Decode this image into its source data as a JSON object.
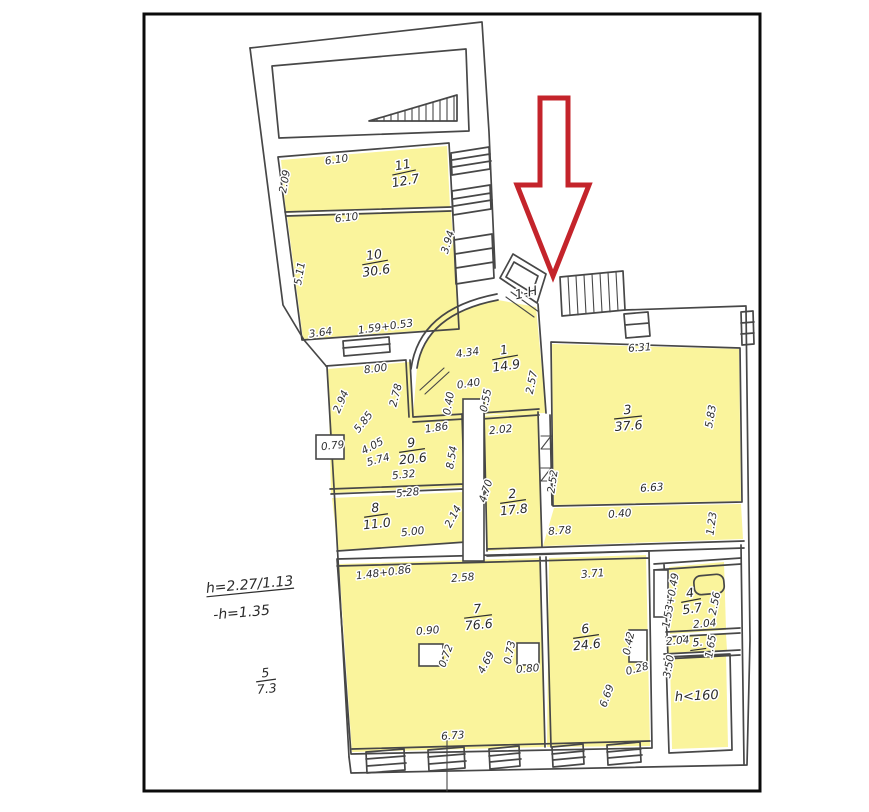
{
  "plan": {
    "type": "apartment-floor-plan-scan",
    "entrance_label": "1-Н",
    "colors": {
      "highlight_fill": "#FAF49C",
      "wall_ink": "#474747",
      "arrow_red": "#C4242B",
      "frame_black": "#0b0b0b",
      "paper": "#ffffff"
    }
  },
  "rooms": [
    {
      "name": "room-11-label",
      "num": "11",
      "area": "12.7",
      "x": 404,
      "y": 172,
      "r": -10,
      "w": 24
    },
    {
      "name": "room-10-label",
      "num": "10",
      "area": "30.6",
      "x": 375,
      "y": 262,
      "r": -8,
      "w": 26
    },
    {
      "name": "room-1-label",
      "num": "1",
      "area": "14.9",
      "x": 505,
      "y": 357,
      "r": -8,
      "w": 26
    },
    {
      "name": "room-3-label",
      "num": "3",
      "area": "37.6",
      "x": 628,
      "y": 417,
      "r": -4,
      "w": 28
    },
    {
      "name": "room-9-label",
      "num": "9",
      "area": "20.6",
      "x": 412,
      "y": 450,
      "r": -6,
      "w": 26
    },
    {
      "name": "room-8-label",
      "num": "8",
      "area": "11.0",
      "x": 376,
      "y": 515,
      "r": -6,
      "w": 24
    },
    {
      "name": "room-2-label",
      "num": "2",
      "area": "17.8",
      "x": 513,
      "y": 501,
      "r": -6,
      "w": 26
    },
    {
      "name": "room-7-label",
      "num": "7",
      "area": "76.6",
      "x": 478,
      "y": 616,
      "r": -5,
      "w": 28
    },
    {
      "name": "room-6-label",
      "num": "6",
      "area": "24.6",
      "x": 586,
      "y": 636,
      "r": -6,
      "w": 26
    },
    {
      "name": "room-4-label",
      "num": "4",
      "area": "5.7",
      "x": 691,
      "y": 600,
      "r": -8,
      "w": 20
    },
    {
      "name": "room-5-area-note",
      "num": "5",
      "area": "7.3",
      "x": 266,
      "y": 680,
      "r": -5,
      "w": 20
    }
  ],
  "labels": [
    {
      "name": "entrance-label",
      "t": "1-Н",
      "x": 527,
      "y": 297,
      "r": -12,
      "s": 13
    },
    {
      "name": "height-note-1",
      "t": "h=2.27/1.13",
      "x": 250,
      "y": 589,
      "r": -5,
      "s": 14,
      "ul": 88
    },
    {
      "name": "height-note-2",
      "t": "-h=1.35",
      "x": 242,
      "y": 617,
      "r": -5,
      "s": 14
    },
    {
      "name": "low-height-label",
      "t": "h<160",
      "x": 697,
      "y": 700,
      "r": -3,
      "s": 13
    },
    {
      "name": "room-5-number",
      "t": "5.",
      "x": 698,
      "y": 646,
      "r": -4,
      "s": 11,
      "ul": 16
    }
  ],
  "dimensions": [
    {
      "t": "6.10",
      "x": 337,
      "y": 163,
      "r": -8
    },
    {
      "t": "2.09",
      "x": 288,
      "y": 182,
      "r": -80
    },
    {
      "t": "6.10",
      "x": 347,
      "y": 221,
      "r": -7
    },
    {
      "t": "5.11",
      "x": 303,
      "y": 274,
      "r": -80
    },
    {
      "t": "3.94",
      "x": 451,
      "y": 243,
      "r": -73
    },
    {
      "t": "3.64",
      "x": 321,
      "y": 336,
      "r": -8
    },
    {
      "t": "1.59+0.53",
      "x": 386,
      "y": 330,
      "r": -8
    },
    {
      "t": "8.00",
      "x": 376,
      "y": 372,
      "r": -7
    },
    {
      "t": "2.94",
      "x": 344,
      "y": 403,
      "r": -66
    },
    {
      "t": "5.85",
      "x": 366,
      "y": 424,
      "r": -52
    },
    {
      "t": "4.05",
      "x": 374,
      "y": 449,
      "r": -28
    },
    {
      "t": "5.74",
      "x": 379,
      "y": 463,
      "r": -15
    },
    {
      "t": "0.79",
      "x": 333,
      "y": 449,
      "r": -6
    },
    {
      "t": "2.78",
      "x": 399,
      "y": 396,
      "r": -76
    },
    {
      "t": "1.86",
      "x": 437,
      "y": 431,
      "r": -8
    },
    {
      "t": "0.40",
      "x": 469,
      "y": 387,
      "r": -8
    },
    {
      "t": "0.55",
      "x": 489,
      "y": 401,
      "r": -78
    },
    {
      "t": "0.40",
      "x": 452,
      "y": 404,
      "r": -80
    },
    {
      "t": "4.34",
      "x": 468,
      "y": 356,
      "r": -8
    },
    {
      "t": "2.57",
      "x": 535,
      "y": 383,
      "r": -78
    },
    {
      "t": "2.02",
      "x": 501,
      "y": 433,
      "r": -6
    },
    {
      "t": "4.70",
      "x": 489,
      "y": 492,
      "r": -72
    },
    {
      "t": "8.54",
      "x": 455,
      "y": 458,
      "r": -80
    },
    {
      "t": "5.32",
      "x": 404,
      "y": 478,
      "r": -6
    },
    {
      "t": "5.28",
      "x": 408,
      "y": 496,
      "r": -6
    },
    {
      "t": "2.14",
      "x": 456,
      "y": 518,
      "r": -62
    },
    {
      "t": "5.00",
      "x": 413,
      "y": 535,
      "r": -6
    },
    {
      "t": "6.31",
      "x": 640,
      "y": 351,
      "r": -4
    },
    {
      "t": "5.83",
      "x": 714,
      "y": 417,
      "r": -80
    },
    {
      "t": "6.63",
      "x": 652,
      "y": 491,
      "r": -4
    },
    {
      "t": "2.52",
      "x": 556,
      "y": 482,
      "r": -82
    },
    {
      "t": "0.40",
      "x": 620,
      "y": 517,
      "r": -4
    },
    {
      "t": "1.23",
      "x": 715,
      "y": 524,
      "r": -82
    },
    {
      "t": "8.78",
      "x": 560,
      "y": 534,
      "r": -4
    },
    {
      "t": "1.48+0.86",
      "x": 384,
      "y": 576,
      "r": -7
    },
    {
      "t": "2.58",
      "x": 463,
      "y": 581,
      "r": -5
    },
    {
      "t": "0.90",
      "x": 428,
      "y": 634,
      "r": -5
    },
    {
      "t": "0.72",
      "x": 449,
      "y": 657,
      "r": -70
    },
    {
      "t": "4.69",
      "x": 489,
      "y": 664,
      "r": -62
    },
    {
      "t": "0.73",
      "x": 513,
      "y": 653,
      "r": -78
    },
    {
      "t": "0.80",
      "x": 528,
      "y": 672,
      "r": -5
    },
    {
      "t": "3.71",
      "x": 593,
      "y": 577,
      "r": -5
    },
    {
      "t": "0.42",
      "x": 632,
      "y": 644,
      "r": -78
    },
    {
      "t": "0.28",
      "x": 638,
      "y": 672,
      "r": -15
    },
    {
      "t": "6.69",
      "x": 610,
      "y": 697,
      "r": -70
    },
    {
      "t": "6.73",
      "x": 453,
      "y": 739,
      "r": -4
    },
    {
      "t": "1.53+0.49",
      "x": 674,
      "y": 601,
      "r": -80
    },
    {
      "t": "2.56",
      "x": 718,
      "y": 604,
      "r": -78
    },
    {
      "t": "2.04",
      "x": 705,
      "y": 627,
      "r": -5
    },
    {
      "t": "2.04",
      "x": 678,
      "y": 644,
      "r": -5
    },
    {
      "t": "1.65",
      "x": 714,
      "y": 647,
      "r": -80
    },
    {
      "t": "3.50",
      "x": 672,
      "y": 667,
      "r": -80
    }
  ]
}
